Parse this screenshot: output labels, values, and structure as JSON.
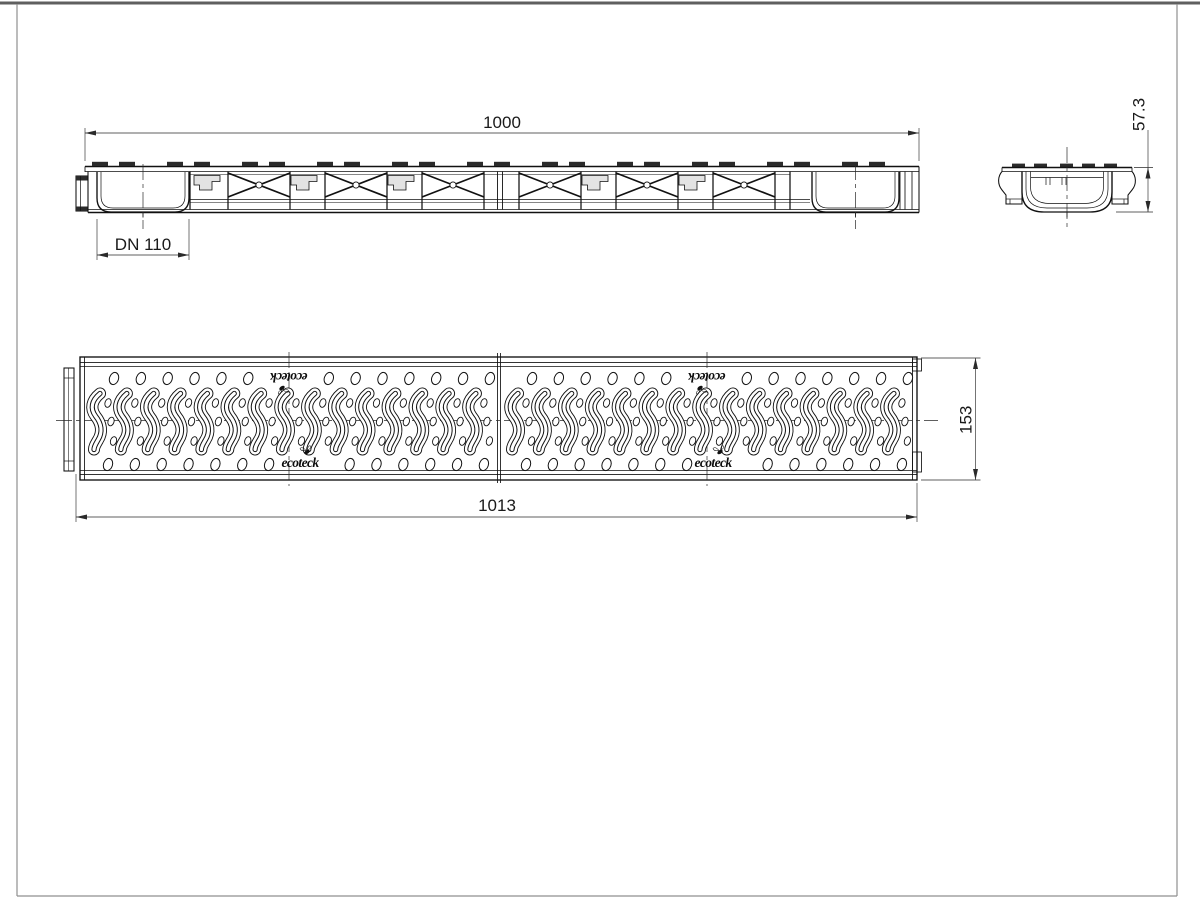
{
  "drawing": {
    "dims": {
      "length": "1000",
      "outlet": "DN 110",
      "height": "57.3",
      "grate_length": "1013",
      "grate_width": "153"
    },
    "logo_text": "ecoteck",
    "colors": {
      "line": "#111111",
      "dim_line": "#2a2a2a",
      "clip_fill": "#2b2b2b",
      "band_fill": "#bcbcbc",
      "bracket_fill": "#e3e3e3",
      "tab_fill": "#d6d6d6",
      "sheet_border": "#8f8f8f",
      "sheet_border_top": "#5f5f5f",
      "background": "#ffffff"
    }
  }
}
